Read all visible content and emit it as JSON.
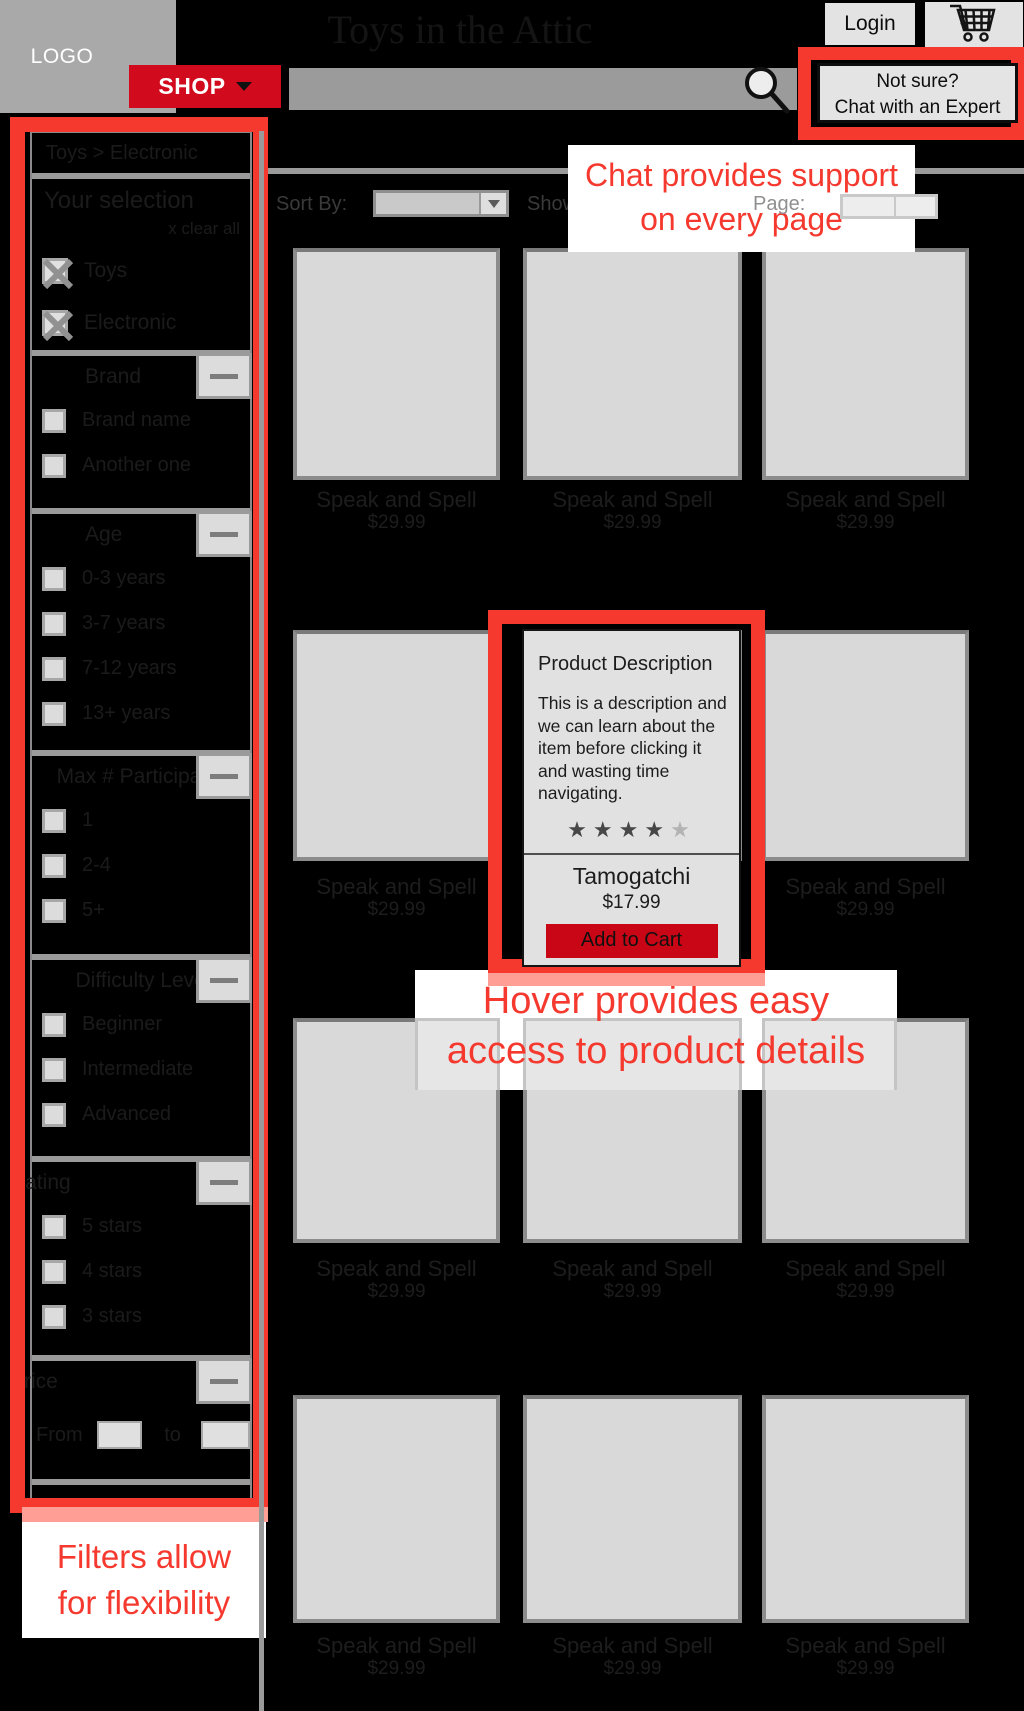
{
  "header": {
    "logo": "LOGO",
    "title": "Toys in the Attic",
    "login": "Login",
    "shop": "SHOP",
    "chat_button": {
      "line1": "Not sure?",
      "line2": "Chat with an Expert"
    },
    "search_value": ""
  },
  "toolbar": {
    "sort_label": "Sort By:",
    "sort_value": "",
    "show_label": "Show:",
    "page_label": "Page:"
  },
  "sidebar": {
    "breadcrumb": "Toys > Electronic",
    "your_selection": "Your selection",
    "clear_all": "x  clear all",
    "selected_filters": [
      "Toys",
      "Electronic"
    ],
    "sections": [
      {
        "title": "Brand",
        "options": [
          "Brand name",
          "Another one"
        ]
      },
      {
        "title": "Age",
        "options": [
          "0-3 years",
          "3-7 years",
          "7-12 years",
          "13+ years"
        ]
      },
      {
        "title": "Max # Participants",
        "options": [
          "1",
          "2-4",
          "5+"
        ]
      },
      {
        "title": "Difficulty Level",
        "options": [
          "Beginner",
          "Intermediate",
          "Advanced"
        ]
      },
      {
        "title": "Rating",
        "options": [
          "5 stars",
          "4 stars",
          "3 stars"
        ]
      },
      {
        "title": "Price",
        "from_label": "From",
        "to_label": "to"
      }
    ]
  },
  "products": {
    "item_name": "Speak and Spell",
    "item_price": "$29.99"
  },
  "popup": {
    "title": "Product Description",
    "description": "This is a description and we can learn about the item before clicking it and wasting time navigating.",
    "rating": 4,
    "rating_max": 5,
    "star_glyph": "★",
    "product_name": "Tamogatchi",
    "product_price": "$17.99",
    "add_to_cart": "Add to Cart"
  },
  "annotations": {
    "chat": {
      "line1": "Chat provides support",
      "line2": "on every page"
    },
    "hover": {
      "line1": "Hover provides easy",
      "line2": "access to product details"
    },
    "filters": {
      "line1": "Filters allow",
      "line2": "for flexibility"
    }
  },
  "colors": {
    "annotation_red": "#f5392e",
    "shadow_salmon": "#ff9e95",
    "shop_red": "#d20a1e",
    "add_to_cart_red": "#c90615",
    "panel_gray": "#d9d9d9"
  }
}
